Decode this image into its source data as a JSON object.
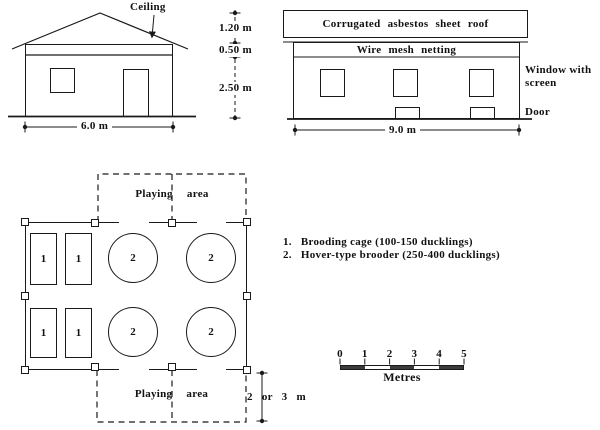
{
  "figure": {
    "front_elevation": {
      "ceiling_label": "Ceiling",
      "width_dim": "6.0 m"
    },
    "height_dims": {
      "roof_height": "1.20 m",
      "netting_height": "0.50 m",
      "wall_height": "2.50 m"
    },
    "side_elevation": {
      "roof_label": "Corrugated asbestos sheet roof",
      "netting_label": "Wire mesh netting",
      "window_label": "Window with screen",
      "door_label": "Door",
      "width_dim": "9.0 m"
    },
    "floor_plan": {
      "playing_area_top_label": "Playing area",
      "playing_area_bottom_label": "Playing area",
      "cage_number": "1",
      "brooder_number": "2",
      "extension_dim": "2 or 3 m"
    },
    "legend": {
      "items": [
        {
          "num": "1.",
          "label": "Brooding cage (100-150 ducklings)"
        },
        {
          "num": "2.",
          "label": "Hover-type brooder (250-400 ducklings)"
        }
      ]
    },
    "scale_bar": {
      "ticks": [
        "0",
        "1",
        "2",
        "3",
        "4",
        "5"
      ],
      "unit_label": "Metres"
    },
    "colors": {
      "line": "#1a1a1a",
      "scale_fill": "#3b3b3b"
    }
  }
}
